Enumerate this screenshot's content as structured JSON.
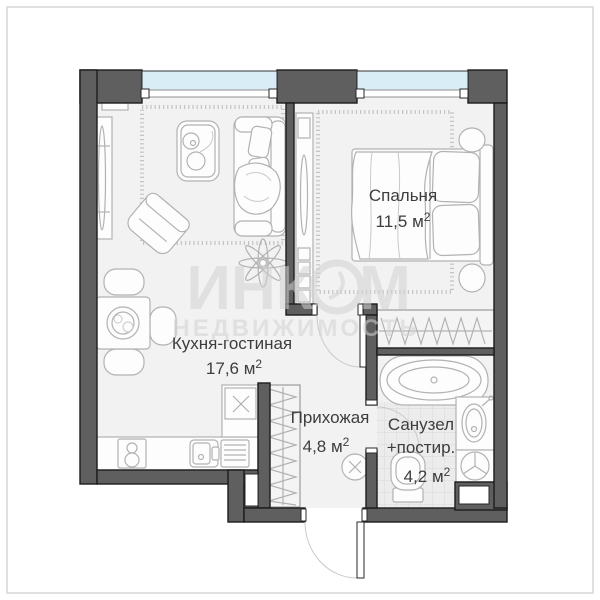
{
  "watermark": {
    "brand_left": "ИНК",
    "brand_right": "М",
    "subtitle": "НЕДВИЖИМОСТЬ"
  },
  "rooms": {
    "living": {
      "name": "Кухня-гостиная",
      "area": "17,6 м",
      "area_sup": "2"
    },
    "bedroom": {
      "name": "Спальня",
      "area": "11,5 м",
      "area_sup": "2"
    },
    "hall": {
      "name": "Прихожая",
      "area": "4,8 м",
      "area_sup": "2"
    },
    "bath": {
      "name": "Санузел",
      "name2": "+постир.",
      "area": "4,2 м",
      "area_sup": "2"
    }
  },
  "colors": {
    "wall": "#5f5f5f",
    "window_glass": "#d9edf6",
    "floor": "#f2f2f2",
    "bath_tile": "#ececec",
    "label_text": "#3d3d3d",
    "watermark": "#d2d2d2"
  }
}
